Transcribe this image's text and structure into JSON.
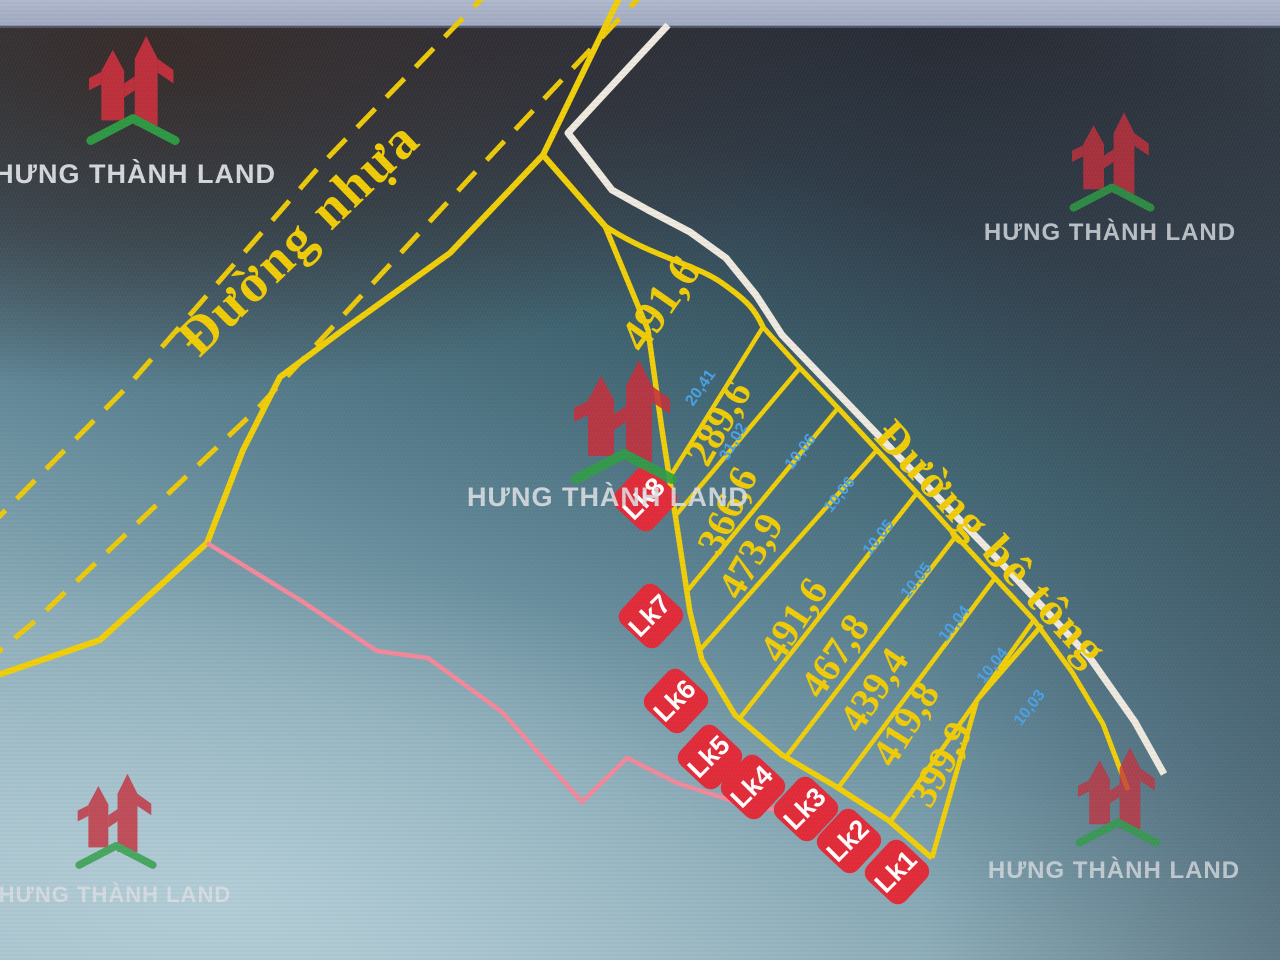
{
  "brand": {
    "name": "HƯNG THÀNH LAND"
  },
  "roads": {
    "asphalt_label": "Đường nhựa",
    "concrete_label": "Đường bê tông"
  },
  "plots": {
    "areas": [
      "491,6",
      "289,6",
      "366,6",
      "473,9",
      "491,6",
      "467,8",
      "439,4",
      "419,8",
      "399,9"
    ]
  },
  "badges": {
    "labels": [
      "Lk8",
      "Lk7",
      "Lk6",
      "Lk5",
      "Lk4",
      "Lk3",
      "Lk2",
      "Lk1"
    ]
  },
  "dimensions": {
    "labels": [
      "20,41",
      "31,02",
      "10,06",
      "10,06",
      "10,05",
      "10,05",
      "10,04",
      "10,04",
      "10,03"
    ]
  },
  "colors": {
    "line_yellow": "#f0cf08",
    "road_white": "#efe9df",
    "boundary_pink": "#f2899b",
    "badge_red": "#e22b38",
    "dim_blue": "#49a2e8",
    "brand_red": "#c5303c",
    "brand_green": "#2f9e44",
    "area_text_yellow": "#f0cc06"
  }
}
